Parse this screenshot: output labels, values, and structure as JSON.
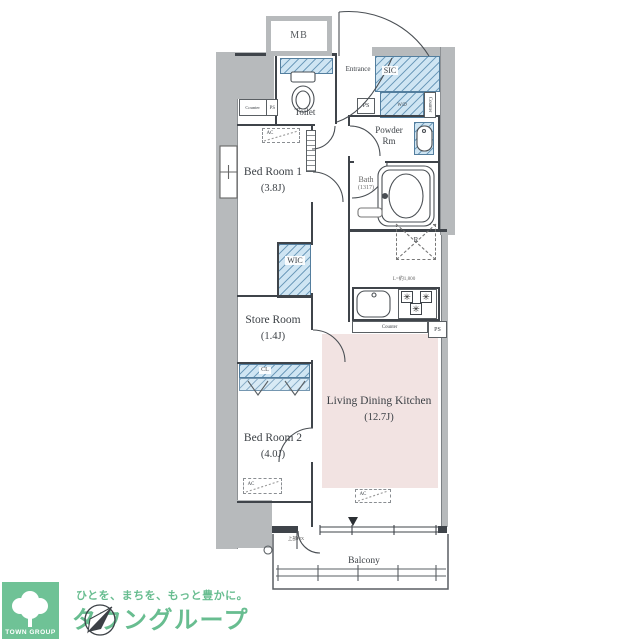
{
  "plan": {
    "rooms": {
      "bedroom1": {
        "name": "Bed Room 1",
        "size": "(3.8J)"
      },
      "storeroom": {
        "name": "Store Room",
        "size": "(1.4J)"
      },
      "bedroom2": {
        "name": "Bed Room 2",
        "size": "(4.0J)"
      },
      "ldk": {
        "name": "Living Dining Kitchen",
        "size": "(12.7J)"
      },
      "bath": {
        "name": "Bath",
        "size": "(1317)"
      },
      "powder": {
        "name_line1": "Powder",
        "name_line2": "Rm"
      },
      "toilet": {
        "name": "Toilet"
      },
      "entrance": {
        "name": "Entrance"
      },
      "balcony": {
        "name": "Balcony"
      },
      "wic": {
        "name": "WIC"
      },
      "sic": {
        "name": "SIC"
      },
      "mb": {
        "name": "MB"
      },
      "closet": {
        "name": "CL"
      }
    },
    "fixtures": {
      "counter": "Counter",
      "ps": "PS",
      "wd": "W/D",
      "ac": "AC",
      "refrigerator": "R",
      "kitchen_counter_length": "L=約1,800",
      "balcony_window_note": "上部FIX"
    }
  },
  "logo": {
    "company_en": "TOWN GROUP",
    "tagline": "ひとを、まちを、もっと豊かに。",
    "company_ja": "タウングループ"
  },
  "icons": {
    "burner": "✳"
  },
  "colors": {
    "wall": "#3f444a",
    "concrete_grey": "#b7babc",
    "closet_fill": "#cfe5f3",
    "closet_line": "#537e9e",
    "floor_accent_pink": "#f2e3e2",
    "brand_green": "#6fc296"
  }
}
